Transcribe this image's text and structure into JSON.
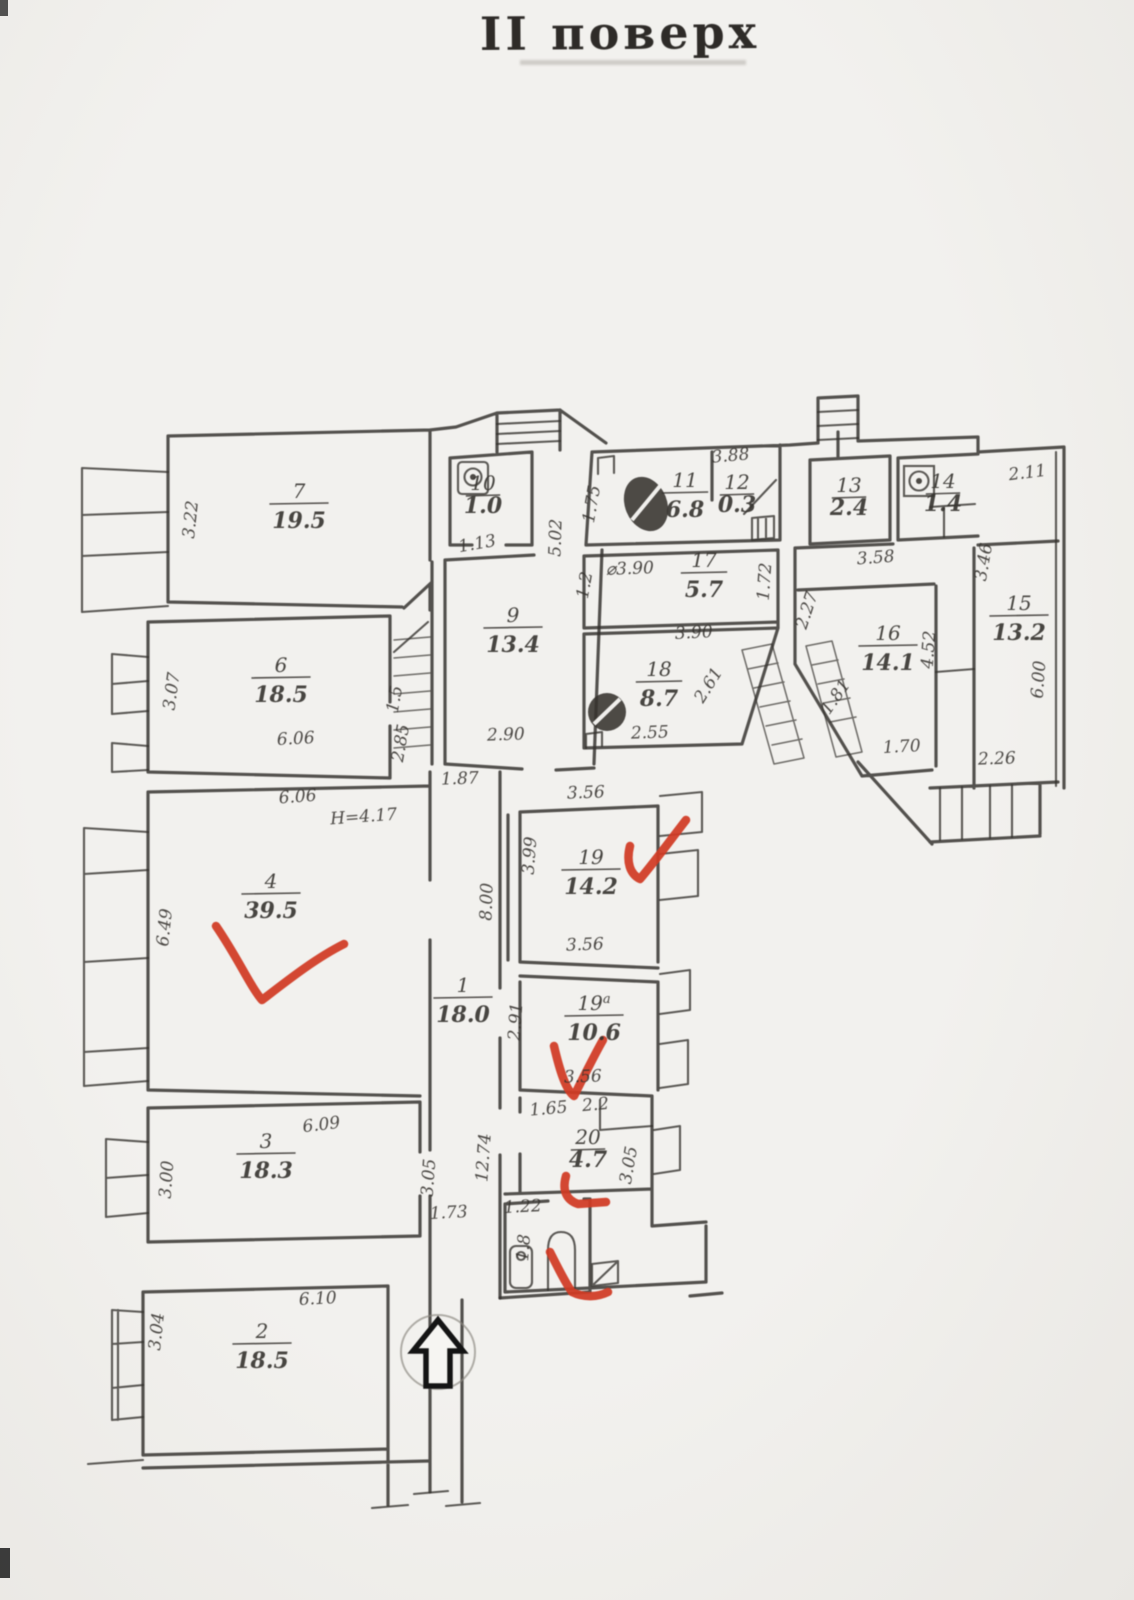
{
  "title": "II поверх",
  "palette": {
    "paper": "#f0efec",
    "ink": "#35322e",
    "red": "#d13a24"
  },
  "plan": {
    "floor_label": "II поверх",
    "rooms": [
      {
        "n": "7",
        "a": "19.5",
        "x": 299,
        "y": 498
      },
      {
        "n": "6",
        "a": "18.5",
        "x": 281,
        "y": 672
      },
      {
        "n": "4",
        "a": "39.5",
        "x": 271,
        "y": 888
      },
      {
        "n": "3",
        "a": "18.3",
        "x": 266,
        "y": 1148
      },
      {
        "n": "2",
        "a": "18.5",
        "x": 262,
        "y": 1338
      },
      {
        "n": "1",
        "a": "18.0",
        "x": 463,
        "y": 992
      },
      {
        "n": "9",
        "a": "13.4",
        "x": 513,
        "y": 622
      },
      {
        "n": "10",
        "a": "1.0",
        "x": 483,
        "y": 490,
        "sm": true
      },
      {
        "n": "11",
        "a": "6.8",
        "x": 685,
        "y": 487
      },
      {
        "n": "12",
        "a": "0.3",
        "x": 737,
        "y": 489,
        "sm": true
      },
      {
        "n": "17",
        "a": "5.7",
        "x": 704,
        "y": 567
      },
      {
        "n": "18",
        "a": "8.7",
        "x": 659,
        "y": 676
      },
      {
        "n": "13",
        "a": "2.4",
        "x": 849,
        "y": 492,
        "sm": true
      },
      {
        "n": "14",
        "a": "1.4",
        "x": 943,
        "y": 488,
        "sm": true
      },
      {
        "n": "16",
        "a": "14.1",
        "x": 888,
        "y": 640
      },
      {
        "n": "15",
        "a": "13.2",
        "x": 1019,
        "y": 610
      },
      {
        "n": "19",
        "a": "14.2",
        "x": 591,
        "y": 864
      },
      {
        "n": "19",
        "sup": "a",
        "a": "10.6",
        "x": 594,
        "y": 1010
      },
      {
        "n": "20",
        "a": "4.7",
        "x": 588,
        "y": 1144,
        "sm": true
      }
    ],
    "dims": [
      {
        "t": "3.22",
        "x": 196,
        "y": 520,
        "r": -84
      },
      {
        "t": "3.07",
        "x": 177,
        "y": 692,
        "r": -82
      },
      {
        "t": "6.06",
        "x": 296,
        "y": 744,
        "r": -3
      },
      {
        "t": "1.5",
        "x": 400,
        "y": 700,
        "r": -80,
        "s": 13
      },
      {
        "t": "2.85",
        "x": 406,
        "y": 744,
        "r": -80,
        "s": 15
      },
      {
        "t": "6.06",
        "x": 298,
        "y": 802,
        "r": -4
      },
      {
        "t": "H=4.17",
        "x": 364,
        "y": 822,
        "r": -4,
        "s": 17
      },
      {
        "t": "6.49",
        "x": 170,
        "y": 928,
        "r": -84
      },
      {
        "t": "6.09",
        "x": 322,
        "y": 1130,
        "r": -7
      },
      {
        "t": "3.00",
        "x": 172,
        "y": 1180,
        "r": -86
      },
      {
        "t": "6.10",
        "x": 318,
        "y": 1304,
        "r": -3
      },
      {
        "t": "3.04",
        "x": 162,
        "y": 1332,
        "r": -84
      },
      {
        "t": "1.73",
        "x": 449,
        "y": 1218,
        "r": -3
      },
      {
        "t": "3.05",
        "x": 434,
        "y": 1178,
        "r": -86
      },
      {
        "t": "12.74",
        "x": 489,
        "y": 1158,
        "r": -86
      },
      {
        "t": "8.00",
        "x": 492,
        "y": 902,
        "r": -88
      },
      {
        "t": "2.91",
        "x": 521,
        "y": 1022,
        "r": -86
      },
      {
        "t": "3.99",
        "x": 535,
        "y": 856,
        "r": -86
      },
      {
        "t": "3.56",
        "x": 586,
        "y": 798,
        "r": -2
      },
      {
        "t": "3.56",
        "x": 585,
        "y": 950,
        "r": -2
      },
      {
        "t": "3.56",
        "x": 583,
        "y": 1082,
        "r": -2
      },
      {
        "t": "2.90",
        "x": 506,
        "y": 740,
        "r": -2
      },
      {
        "t": "1.87",
        "x": 460,
        "y": 784,
        "r": -2,
        "s": 15
      },
      {
        "t": "1.13",
        "x": 478,
        "y": 549,
        "r": -10,
        "s": 15
      },
      {
        "t": "5.02",
        "x": 561,
        "y": 538,
        "r": -88
      },
      {
        "t": "1.75",
        "x": 597,
        "y": 505,
        "r": -80,
        "s": 15
      },
      {
        "t": "3.88",
        "x": 731,
        "y": 461,
        "r": -5,
        "s": 15
      },
      {
        "t": "1.72",
        "x": 770,
        "y": 582,
        "r": -86,
        "s": 15
      },
      {
        "t": "1.2",
        "x": 590,
        "y": 586,
        "r": -80,
        "s": 13
      },
      {
        "t": "3.90",
        "x": 694,
        "y": 638,
        "r": -3
      },
      {
        "t": "2.55",
        "x": 650,
        "y": 738,
        "r": -2
      },
      {
        "t": "2.61",
        "x": 713,
        "y": 688,
        "r": -58,
        "s": 15
      },
      {
        "t": "3.58",
        "x": 876,
        "y": 563,
        "r": -4
      },
      {
        "t": "2.27",
        "x": 812,
        "y": 612,
        "r": -72,
        "s": 15
      },
      {
        "t": "4.52",
        "x": 934,
        "y": 650,
        "r": -86
      },
      {
        "t": "1.81",
        "x": 840,
        "y": 700,
        "r": -55,
        "s": 15
      },
      {
        "t": "1.70",
        "x": 902,
        "y": 752,
        "r": -3
      },
      {
        "t": "2.11",
        "x": 1028,
        "y": 478,
        "r": -7,
        "s": 15
      },
      {
        "t": "3.46",
        "x": 989,
        "y": 563,
        "r": -80,
        "s": 15
      },
      {
        "t": "6.00",
        "x": 1044,
        "y": 680,
        "r": -86
      },
      {
        "t": "2.26",
        "x": 997,
        "y": 764,
        "r": -2
      },
      {
        "t": "1.65",
        "x": 549,
        "y": 1114,
        "r": -5,
        "s": 13
      },
      {
        "t": "2.2",
        "x": 596,
        "y": 1110,
        "r": -5,
        "s": 13
      },
      {
        "t": "3.05",
        "x": 634,
        "y": 1166,
        "r": -80
      },
      {
        "t": "1.22",
        "x": 523,
        "y": 1212,
        "r": -3,
        "s": 14
      },
      {
        "t": "1.8",
        "x": 529,
        "y": 1248,
        "r": -86,
        "s": 13
      },
      {
        "t": "⌀3.90",
        "x": 630,
        "y": 574,
        "r": -2,
        "s": 15
      }
    ],
    "icons": [
      "toilet-icon",
      "sink-icon",
      "fixture-icon",
      "washbasin-icon",
      "toilet-bowl-icon",
      "water-heater-icon",
      "entrance-arrow-icon"
    ],
    "annotations": [
      "red-checkmark-room-4",
      "red-checkmark-room-19",
      "red-checkmark-room-19a",
      "red-bracket-room-20",
      "red-checkmark-wc"
    ]
  }
}
